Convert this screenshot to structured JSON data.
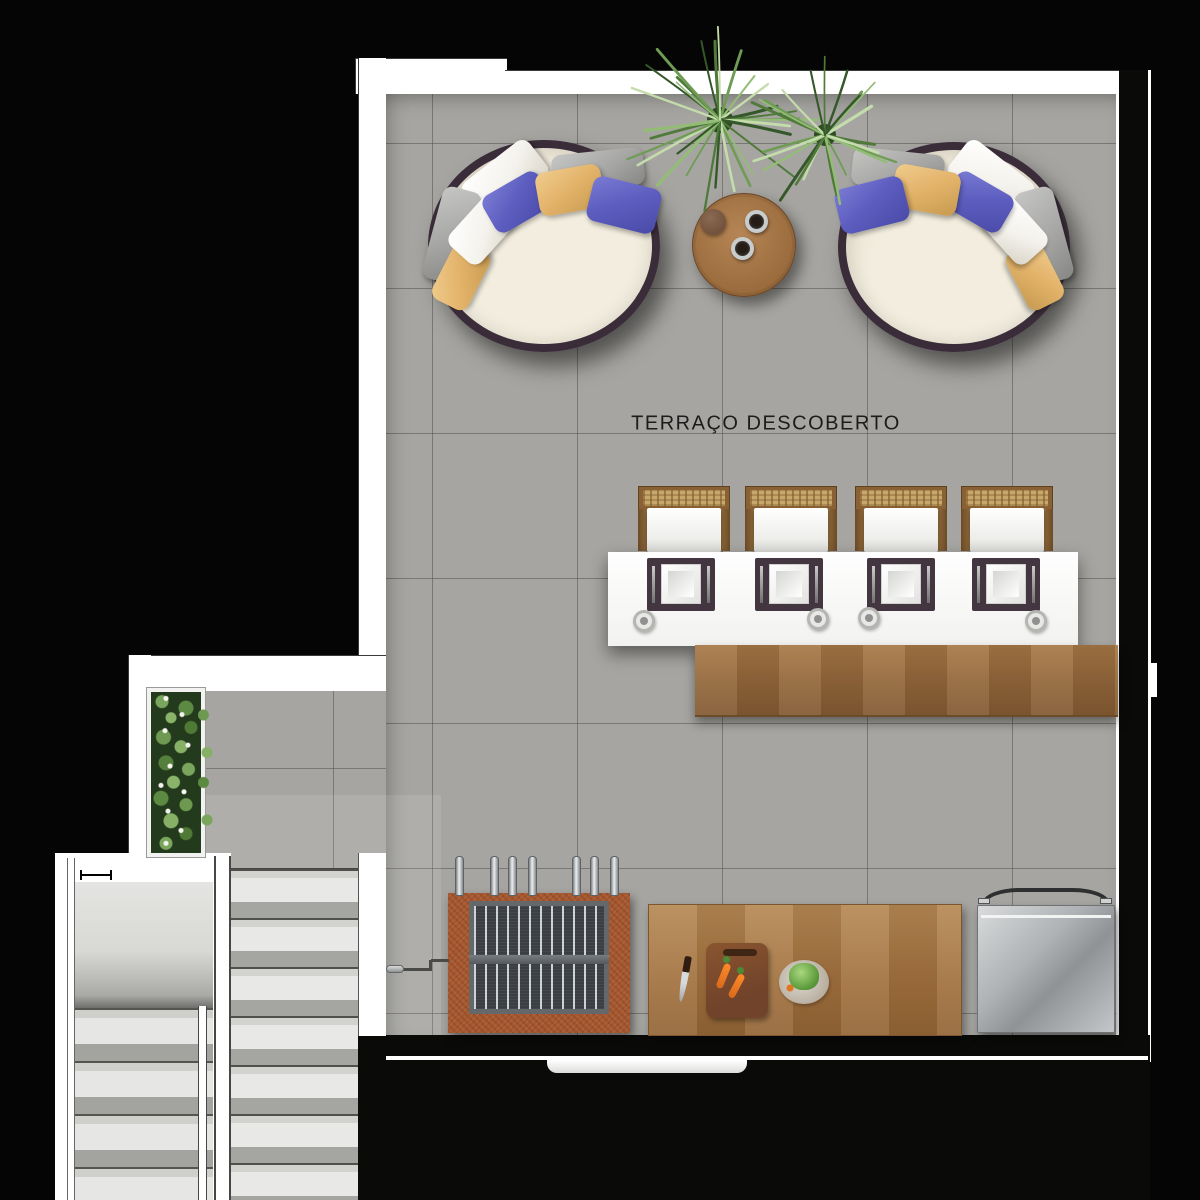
{
  "labels": {
    "terrace": "TERRAÇO DESCOBERTO"
  },
  "palette": {
    "bg": "#050505",
    "floor": "#a6a5a1",
    "grout": "#82817d",
    "wall": "#ffffff",
    "wallDark": "#0a0a09",
    "wood": "#9b7043",
    "woodLight": "#b28354",
    "brick": "#a8582f",
    "charcoal": "#3b3e43",
    "steel": "#aeb2b4",
    "rim": "#3a2d39",
    "cushion": "#efe9dc",
    "pillowBlue": "#5d5ec0",
    "pillowYellow": "#e2b269",
    "pillowWhite": "#f4f2ec",
    "pillowGray": "#a6a6a4",
    "planterSoil": "#243a1c",
    "placemat": "#443640",
    "text": "#1c1c1c"
  },
  "plant_colors": [
    "#35582a",
    "#4f7a3a",
    "#6f9c55",
    "#93bd77",
    "#c4dcab"
  ],
  "furniture": [
    "round daybed with pillows (left)",
    "round daybed with pillows (right)",
    "round wood side table with two cups",
    "two potted palm plants",
    "flower planter bed",
    "dining table with four place settings and glasses",
    "four rattan-back chairs",
    "wood buffet counter",
    "charcoal grill with seven skewers and crank",
    "wood prep table with knife, cutting board, carrots and salad plate",
    "stainless steel appliance",
    "two-flight staircase with landing and handrails"
  ]
}
